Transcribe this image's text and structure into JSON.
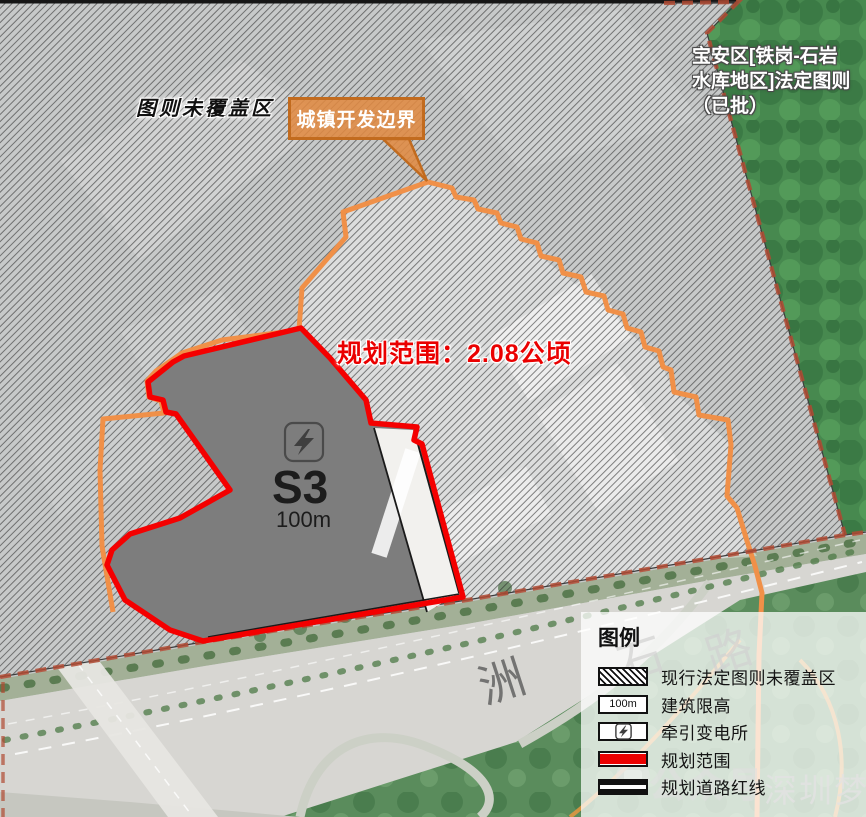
{
  "map": {
    "labels": {
      "uncovered_area": "图则未覆盖区",
      "callout": "城镇开发边界",
      "planning_scope": "规划范围：2.08公顷",
      "approved_plan_lines": [
        "宝安区[铁岗-石岩",
        "水库地区]法定图则",
        "（已批）"
      ],
      "site_code": "S3",
      "height_limit": "100m",
      "road_name_chars": [
        "洲",
        "石",
        "路"
      ]
    },
    "colors": {
      "planning_boundary_red": "#f40000",
      "development_boundary_orange": "#f09048",
      "statutory_boundary_dashed": "#b04a32",
      "parcel_gray": "#7d7d7d",
      "forest_green": "#47894f"
    }
  },
  "legend": {
    "title": "图例",
    "items": [
      {
        "label": "现行法定图则未覆盖区",
        "swatch": "hatch"
      },
      {
        "label": "建筑限高",
        "swatch": "height-limit",
        "swatch_text": "100m"
      },
      {
        "label": "牵引变电所",
        "swatch": "substation"
      },
      {
        "label": "规划范围",
        "swatch": "red-line"
      },
      {
        "label": "规划道路红线",
        "swatch": "road-redline"
      }
    ]
  },
  "watermark": {
    "outline_text": "公众号",
    "name": "深圳梦"
  }
}
